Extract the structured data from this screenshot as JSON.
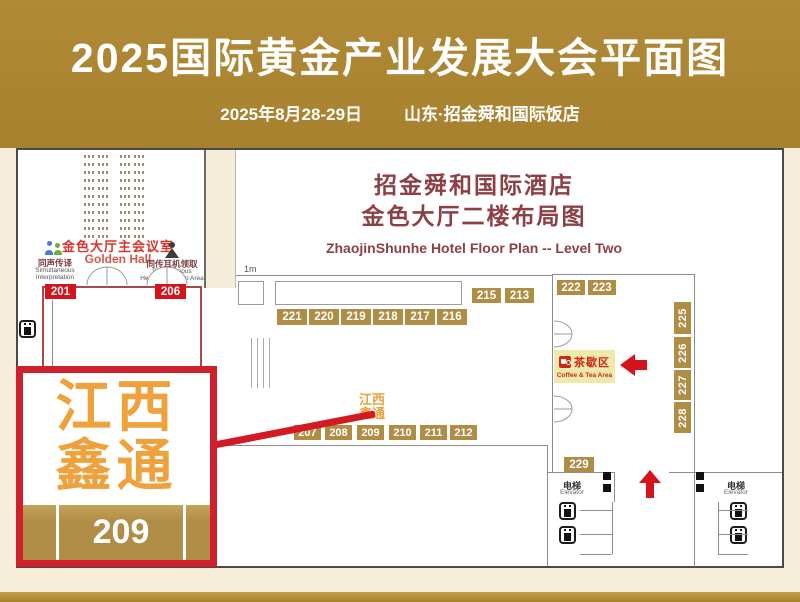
{
  "colors": {
    "banner_gold": "#ac8432",
    "badge_gold": "#b08d45",
    "accent_red": "#d6131c",
    "callout_border_red": "#cf202e",
    "page_cream": "#f7eed9",
    "plan_title_maroon": "#8d3f44",
    "highlight_text_gold": "#efa23b",
    "tea_area_bg": "#efe9ac"
  },
  "header": {
    "title": "2025国际黄金产业发展大会平面图",
    "date": "2025年8月28-29日",
    "venue": "山东·招金舜和国际饭店"
  },
  "plan": {
    "hotel_title": "招金舜和国际酒店",
    "floor_title": "金色大厅二楼布局图",
    "title_en": "ZhaojinShunhe Hotel Floor Plan -- Level Two",
    "scale_label": "1m",
    "hall": {
      "name_cn": "金色大厅主会议室",
      "name_en": "Golden Hall",
      "interpretation_cn": "同声传译",
      "interpretation_en": "Simultaneous Interpretation",
      "headset_cn": "同传耳机领取",
      "headset_en": "Simultaneous Headset Pick Up Area",
      "seating": {
        "rows": 11,
        "groups_per_row": 4
      }
    },
    "booths": {
      "hall_row": [
        "201",
        "206"
      ],
      "top_row": [
        "221",
        "220",
        "219",
        "218",
        "217",
        "216"
      ],
      "upper_pair": [
        "215",
        "213"
      ],
      "right_top_pair": [
        "222",
        "223"
      ],
      "right_column": [
        "225",
        "226",
        "227",
        "228"
      ],
      "bottom_row": [
        "207",
        "208",
        "209",
        "210",
        "211",
        "212"
      ],
      "corridor": [
        "229"
      ]
    },
    "highlight_booth": {
      "label_line1": "江西",
      "label_line2": "鑫通",
      "booth": "209"
    },
    "tea_area": {
      "name_cn": "茶歇区",
      "name_en": "Coffee & Tea Area"
    },
    "elevator": {
      "name_cn": "电梯",
      "name_en": "Elevator"
    }
  },
  "callout": {
    "line1": "江西",
    "line2": "鑫通",
    "booth": "209"
  }
}
